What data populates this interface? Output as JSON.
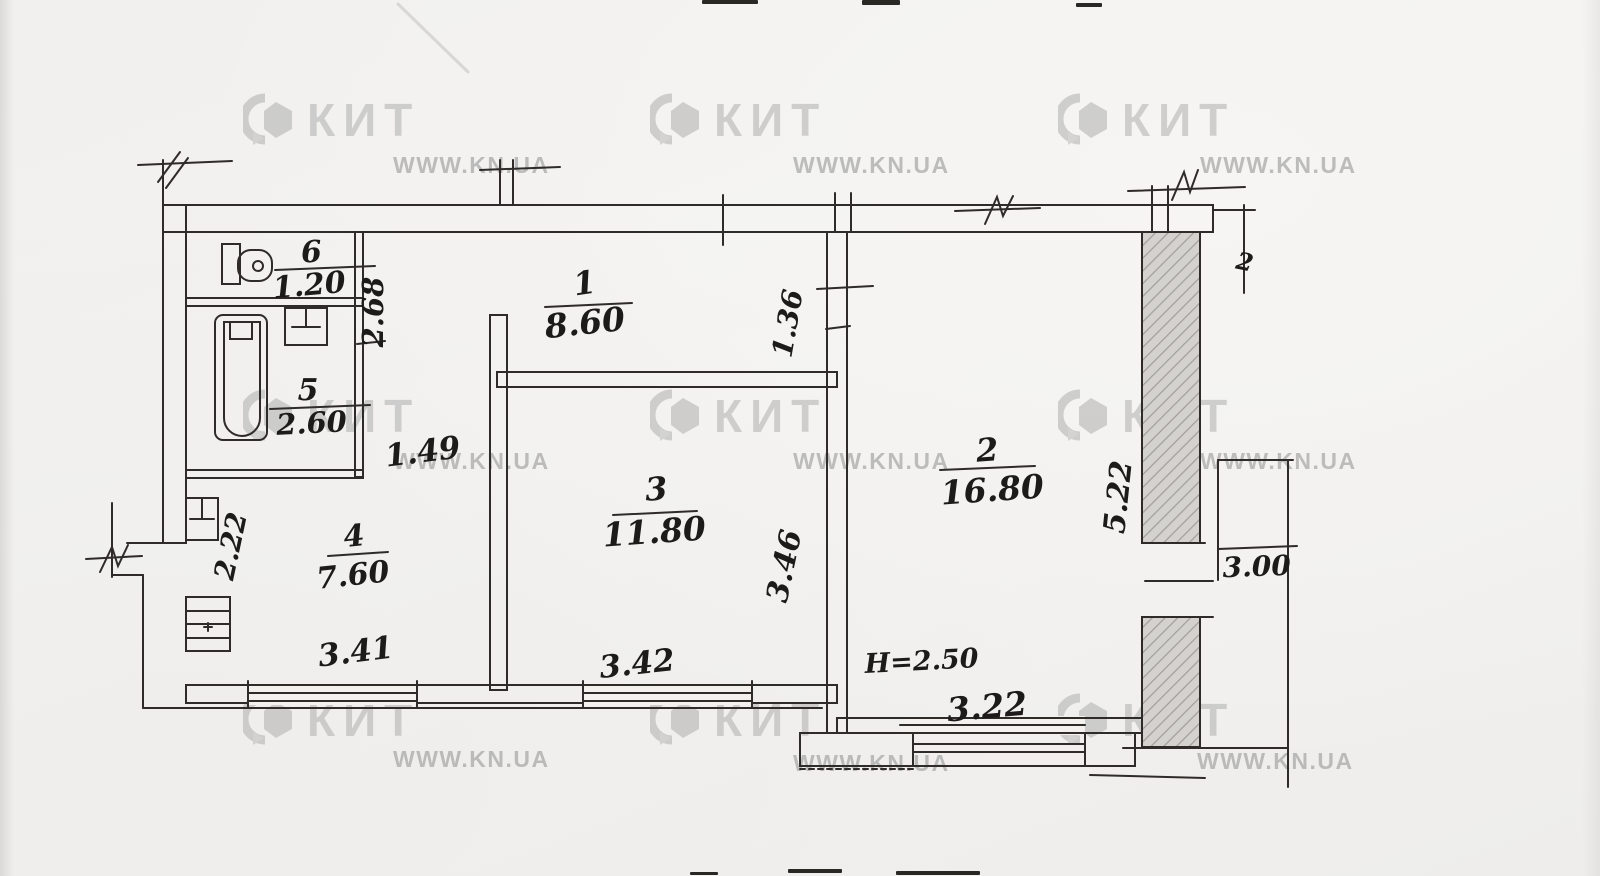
{
  "watermark": {
    "brand": "КИТ",
    "url": "WWW.KN.UA"
  },
  "plan": {
    "rooms": [
      {
        "number": "1",
        "area": "8.60"
      },
      {
        "number": "2",
        "area": "16.80"
      },
      {
        "number": "3",
        "area": "11.80"
      },
      {
        "number": "4",
        "area": "7.60"
      },
      {
        "number": "5",
        "area": "2.60"
      },
      {
        "number": "6",
        "area": "1.20"
      }
    ],
    "dimensions": {
      "hall_niche": "1.49",
      "bath_depth": "2.68",
      "hall_end": "1.36",
      "room3_width": "3.46",
      "kitchen_niche": "2.22",
      "kitchen_window": "3.41",
      "room3_window": "3.42",
      "room2_window": "3.22",
      "room2_depth": "5.22",
      "right_annex": "3.00",
      "ceiling_height": "H=2.50",
      "edge_mark": "2"
    },
    "colors": {
      "ink": "#2e2b28",
      "paper": "#f2f1ee",
      "watermark": "#bdbdbd",
      "hatch": "#a8a5a1"
    }
  }
}
